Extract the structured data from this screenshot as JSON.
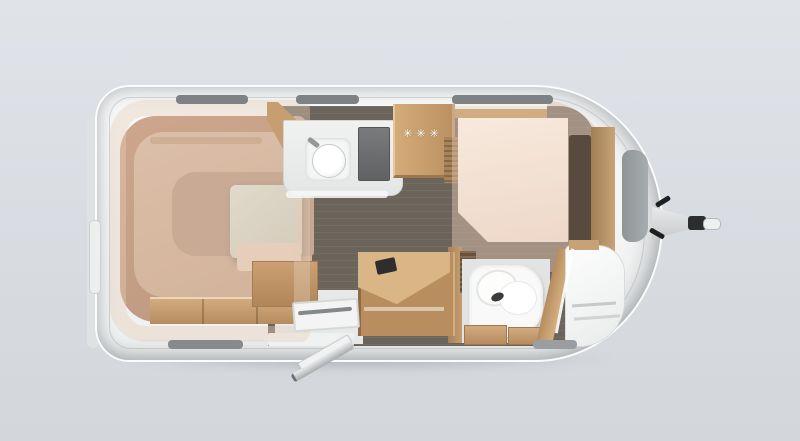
{
  "scene": {
    "description": "Top-down 3D floor plan rendering of a single-axle caravan",
    "background_color": "#d8dce1"
  },
  "caravan": {
    "body_color": "#f6f7f7",
    "floor_color": "#6b645b",
    "wood_color": "#c49a6e",
    "upholstery_color": "#d6b8a2",
    "mattress_color": "#f3e4d8",
    "table_color": "#dcd5c6",
    "fixture_color": "#f8f9f8",
    "window_frame_color": "#7e8284",
    "fridge": {
      "freezer_rating": "✳✳✳"
    },
    "window_count": {
      "top_wall": 3,
      "bottom_wall": 2,
      "rear_wall": 1,
      "front_wall": 1
    }
  }
}
